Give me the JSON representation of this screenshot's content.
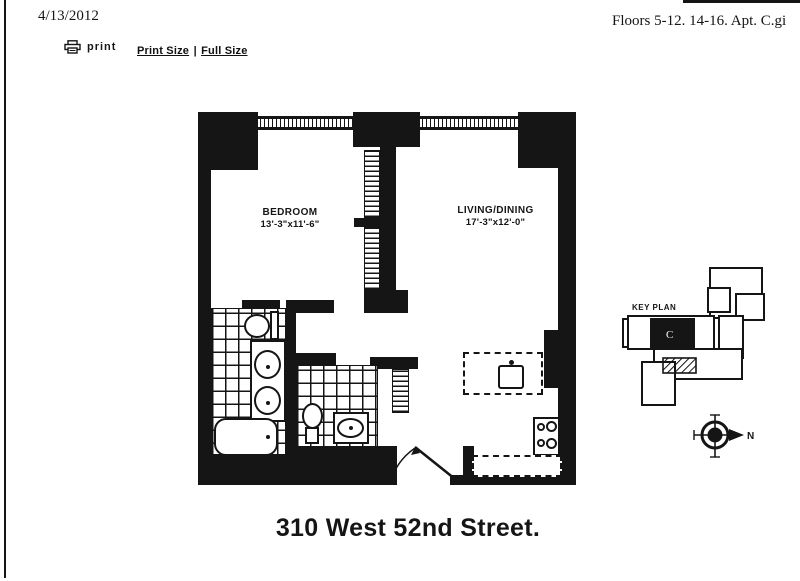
{
  "header": {
    "date": "4/13/2012",
    "right_text": "Floors 5-12. 14-16. Apt. C.gi",
    "print_label": "print",
    "print_size": "Print Size",
    "divider": "|",
    "full_size": "Full Size"
  },
  "plan": {
    "bedroom": {
      "name": "BEDROOM",
      "dims": "13'-3\"x11'-6\""
    },
    "living": {
      "name": "LIVING/DINING",
      "dims": "17'-3\"x12'-0\""
    },
    "asterisk": "*"
  },
  "keyplan": {
    "label": "KEY PLAN",
    "unit": "C"
  },
  "compass": {
    "north": "N"
  },
  "footer": {
    "title": "310 West 52nd Street."
  },
  "colors": {
    "ink": "#151515",
    "paper": "#ffffff"
  }
}
